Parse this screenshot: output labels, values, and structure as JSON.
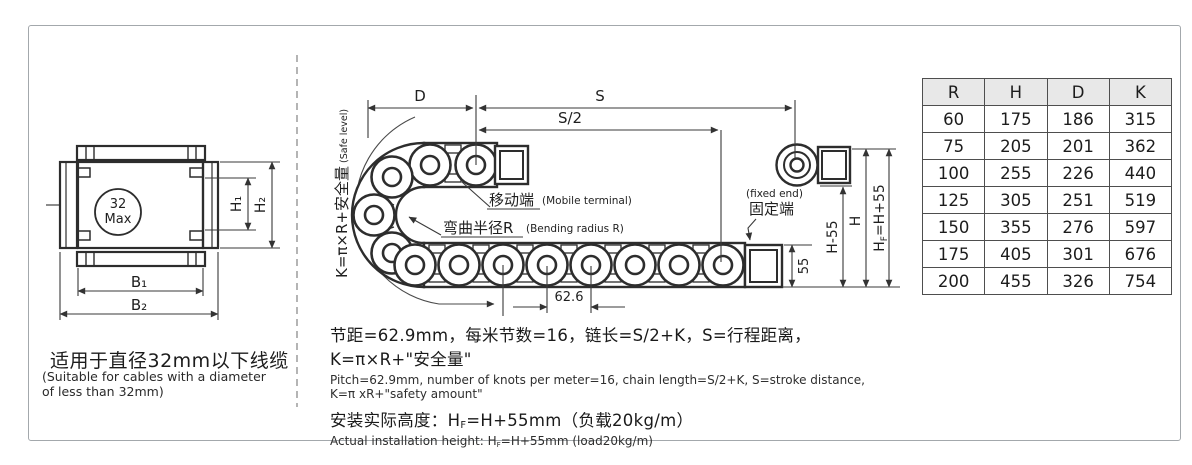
{
  "left": {
    "circle_top": "32",
    "circle_bottom": "Max",
    "dim_h1": "H₁",
    "dim_h2": "H₂",
    "dim_b1": "B₁",
    "dim_b2": "B₂",
    "caption_zh": "适用于直径32mm以下线缆",
    "caption_en": "(Suitable for cables with a diameter\n of less than 32mm)"
  },
  "mid": {
    "safe_main": "K=π×R+安全量",
    "safe_sub": " (Safe level)",
    "dim_d": "D",
    "dim_s": "S",
    "dim_s2": "S/2",
    "dim_pitch": "62.6",
    "dim_55": "55",
    "dim_h55": "H-55",
    "dim_h": "H",
    "hf_h": "H",
    "hf_f": "F",
    "hf_rest": "=H+55",
    "mobile_zh": "移动端",
    "mobile_en": "(Mobile terminal)",
    "bend_zh": "弯曲半径R",
    "bend_en": "(Bending radius R)",
    "fixed_en": "(fixed end)",
    "fixed_zh": "固定端"
  },
  "notes": {
    "line1_zh": "节距=62.9mm，每米节数=16，链长=S/2+K，S=行程距离，K=π×R+\"安全量\"",
    "line1_en": "Pitch=62.9mm, number of knots per meter=16, chain length=S/2+K, S=stroke distance, K=π xR+\"safety amount\"",
    "line2_zh_pre": "安装实际高度：H",
    "line2_zh_sub": "F",
    "line2_zh_post": "=H+55mm（负载20kg/m）",
    "line2_en_pre": "Actual installation height: H",
    "line2_en_sub": "F",
    "line2_en_post": "=H+55mm (load20kg/m)"
  },
  "table": {
    "headers": [
      "R",
      "H",
      "D",
      "K"
    ],
    "rows": [
      [
        "60",
        "175",
        "186",
        "315"
      ],
      [
        "75",
        "205",
        "201",
        "362"
      ],
      [
        "100",
        "255",
        "226",
        "440"
      ],
      [
        "125",
        "305",
        "251",
        "519"
      ],
      [
        "150",
        "355",
        "276",
        "597"
      ],
      [
        "175",
        "405",
        "301",
        "676"
      ],
      [
        "200",
        "455",
        "326",
        "754"
      ]
    ]
  }
}
